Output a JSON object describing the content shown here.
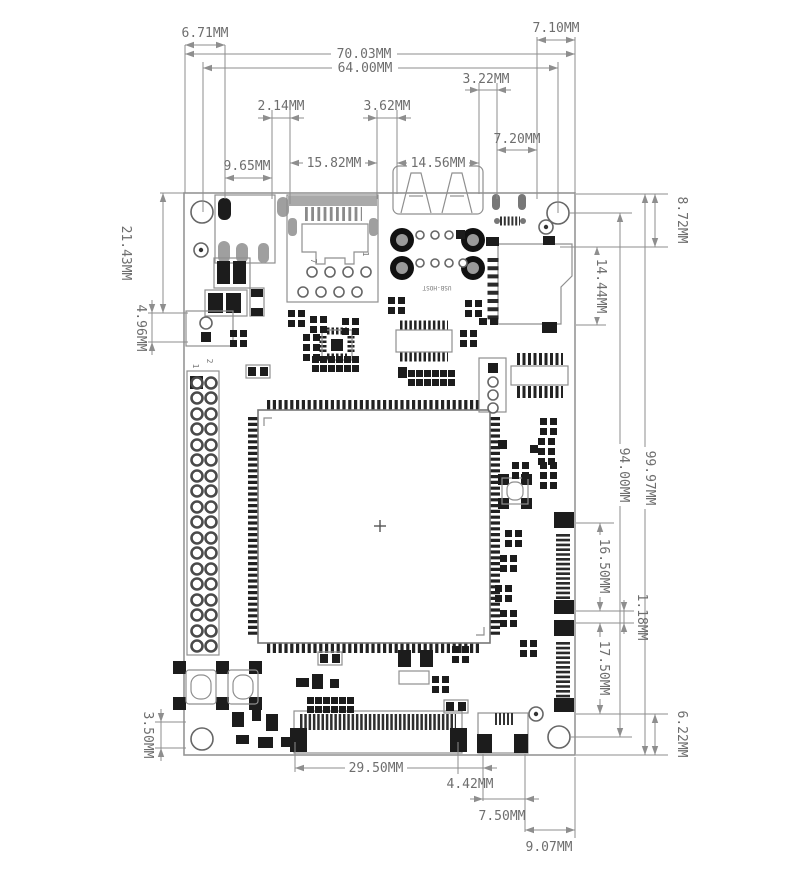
{
  "dims": {
    "d671": "6.71MM",
    "d7003": "70.03MM",
    "d6400": "64.00MM",
    "d710": "7.10MM",
    "d214": "2.14MM",
    "d965": "9.65MM",
    "d1582": "15.82MM",
    "d362": "3.62MM",
    "d1456": "14.56MM",
    "d322": "3.22MM",
    "d720": "7.20MM",
    "d2143": "21.43MM",
    "d496": "4.96MM",
    "d350": "3.50MM",
    "d872": "8.72MM",
    "d1444": "14.44MM",
    "d9400": "94.00MM",
    "d9997": "99.97MM",
    "d1650": "16.50MM",
    "d118": "1.18MM",
    "d1750": "17.50MM",
    "d622": "6.22MM",
    "d2950": "29.50MM",
    "d442": "4.42MM",
    "d750": "7.50MM",
    "d907": "9.07MM"
  },
  "silkscreen": {
    "usb_host": "USB-HOST",
    "gpio_pin1": "1",
    "gpio_pin2": "2",
    "rj45_pin7": "7",
    "rj45_pin1": "1"
  }
}
